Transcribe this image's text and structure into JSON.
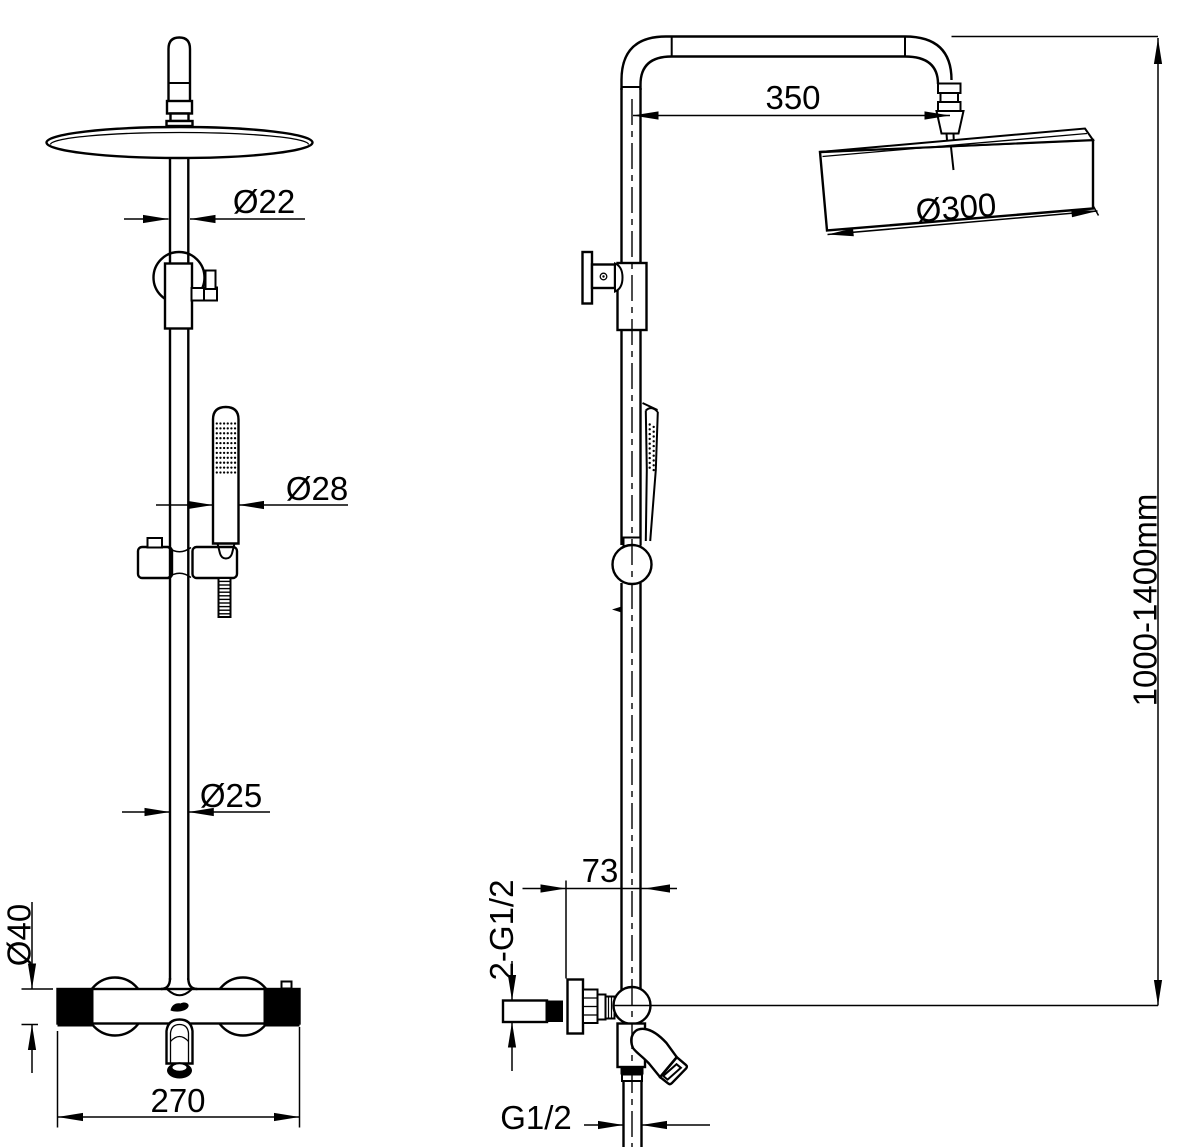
{
  "dimensions": {
    "front": {
      "top_pipe_diameter": "Ø22",
      "hand_shower_diameter": "Ø28",
      "riser_diameter": "Ø25",
      "valve_body_diameter": "Ø40",
      "valve_width": "270"
    },
    "side": {
      "arm_length": "350",
      "head_diameter": "Ø300",
      "riser_height_range": "1000-1400mm",
      "wall_to_riser_center": "73",
      "inlet_connection": "2-G1/2",
      "hose_connection": "G1/2"
    }
  }
}
